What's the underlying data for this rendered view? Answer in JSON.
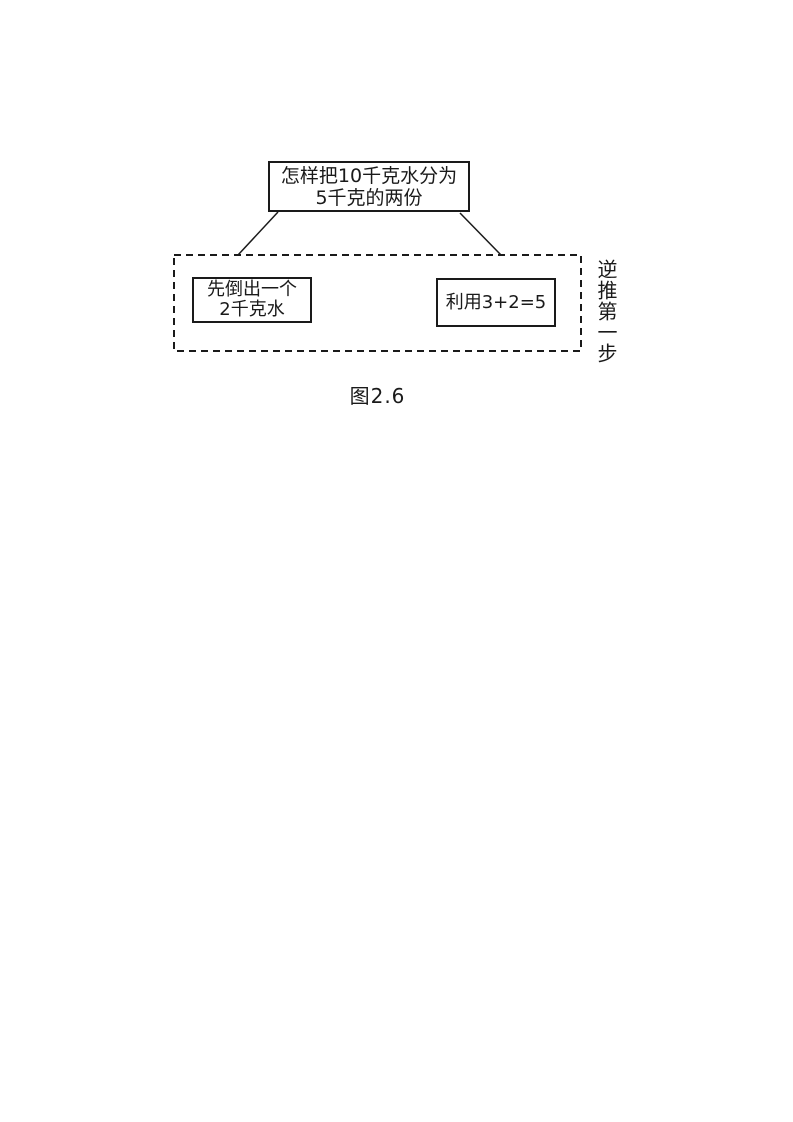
{
  "diagram": {
    "top_box": {
      "line1": "怎样把10千克水分为",
      "line2": "5千克的两份"
    },
    "left_box": {
      "line1": "先倒出一个",
      "line2": "2千克水"
    },
    "right_box": {
      "label": "利用3+2=5"
    },
    "side_label": "逆推第一步",
    "caption": "图2.6"
  },
  "colors": {
    "ink": "#1a1a1a",
    "background": "#ffffff"
  }
}
